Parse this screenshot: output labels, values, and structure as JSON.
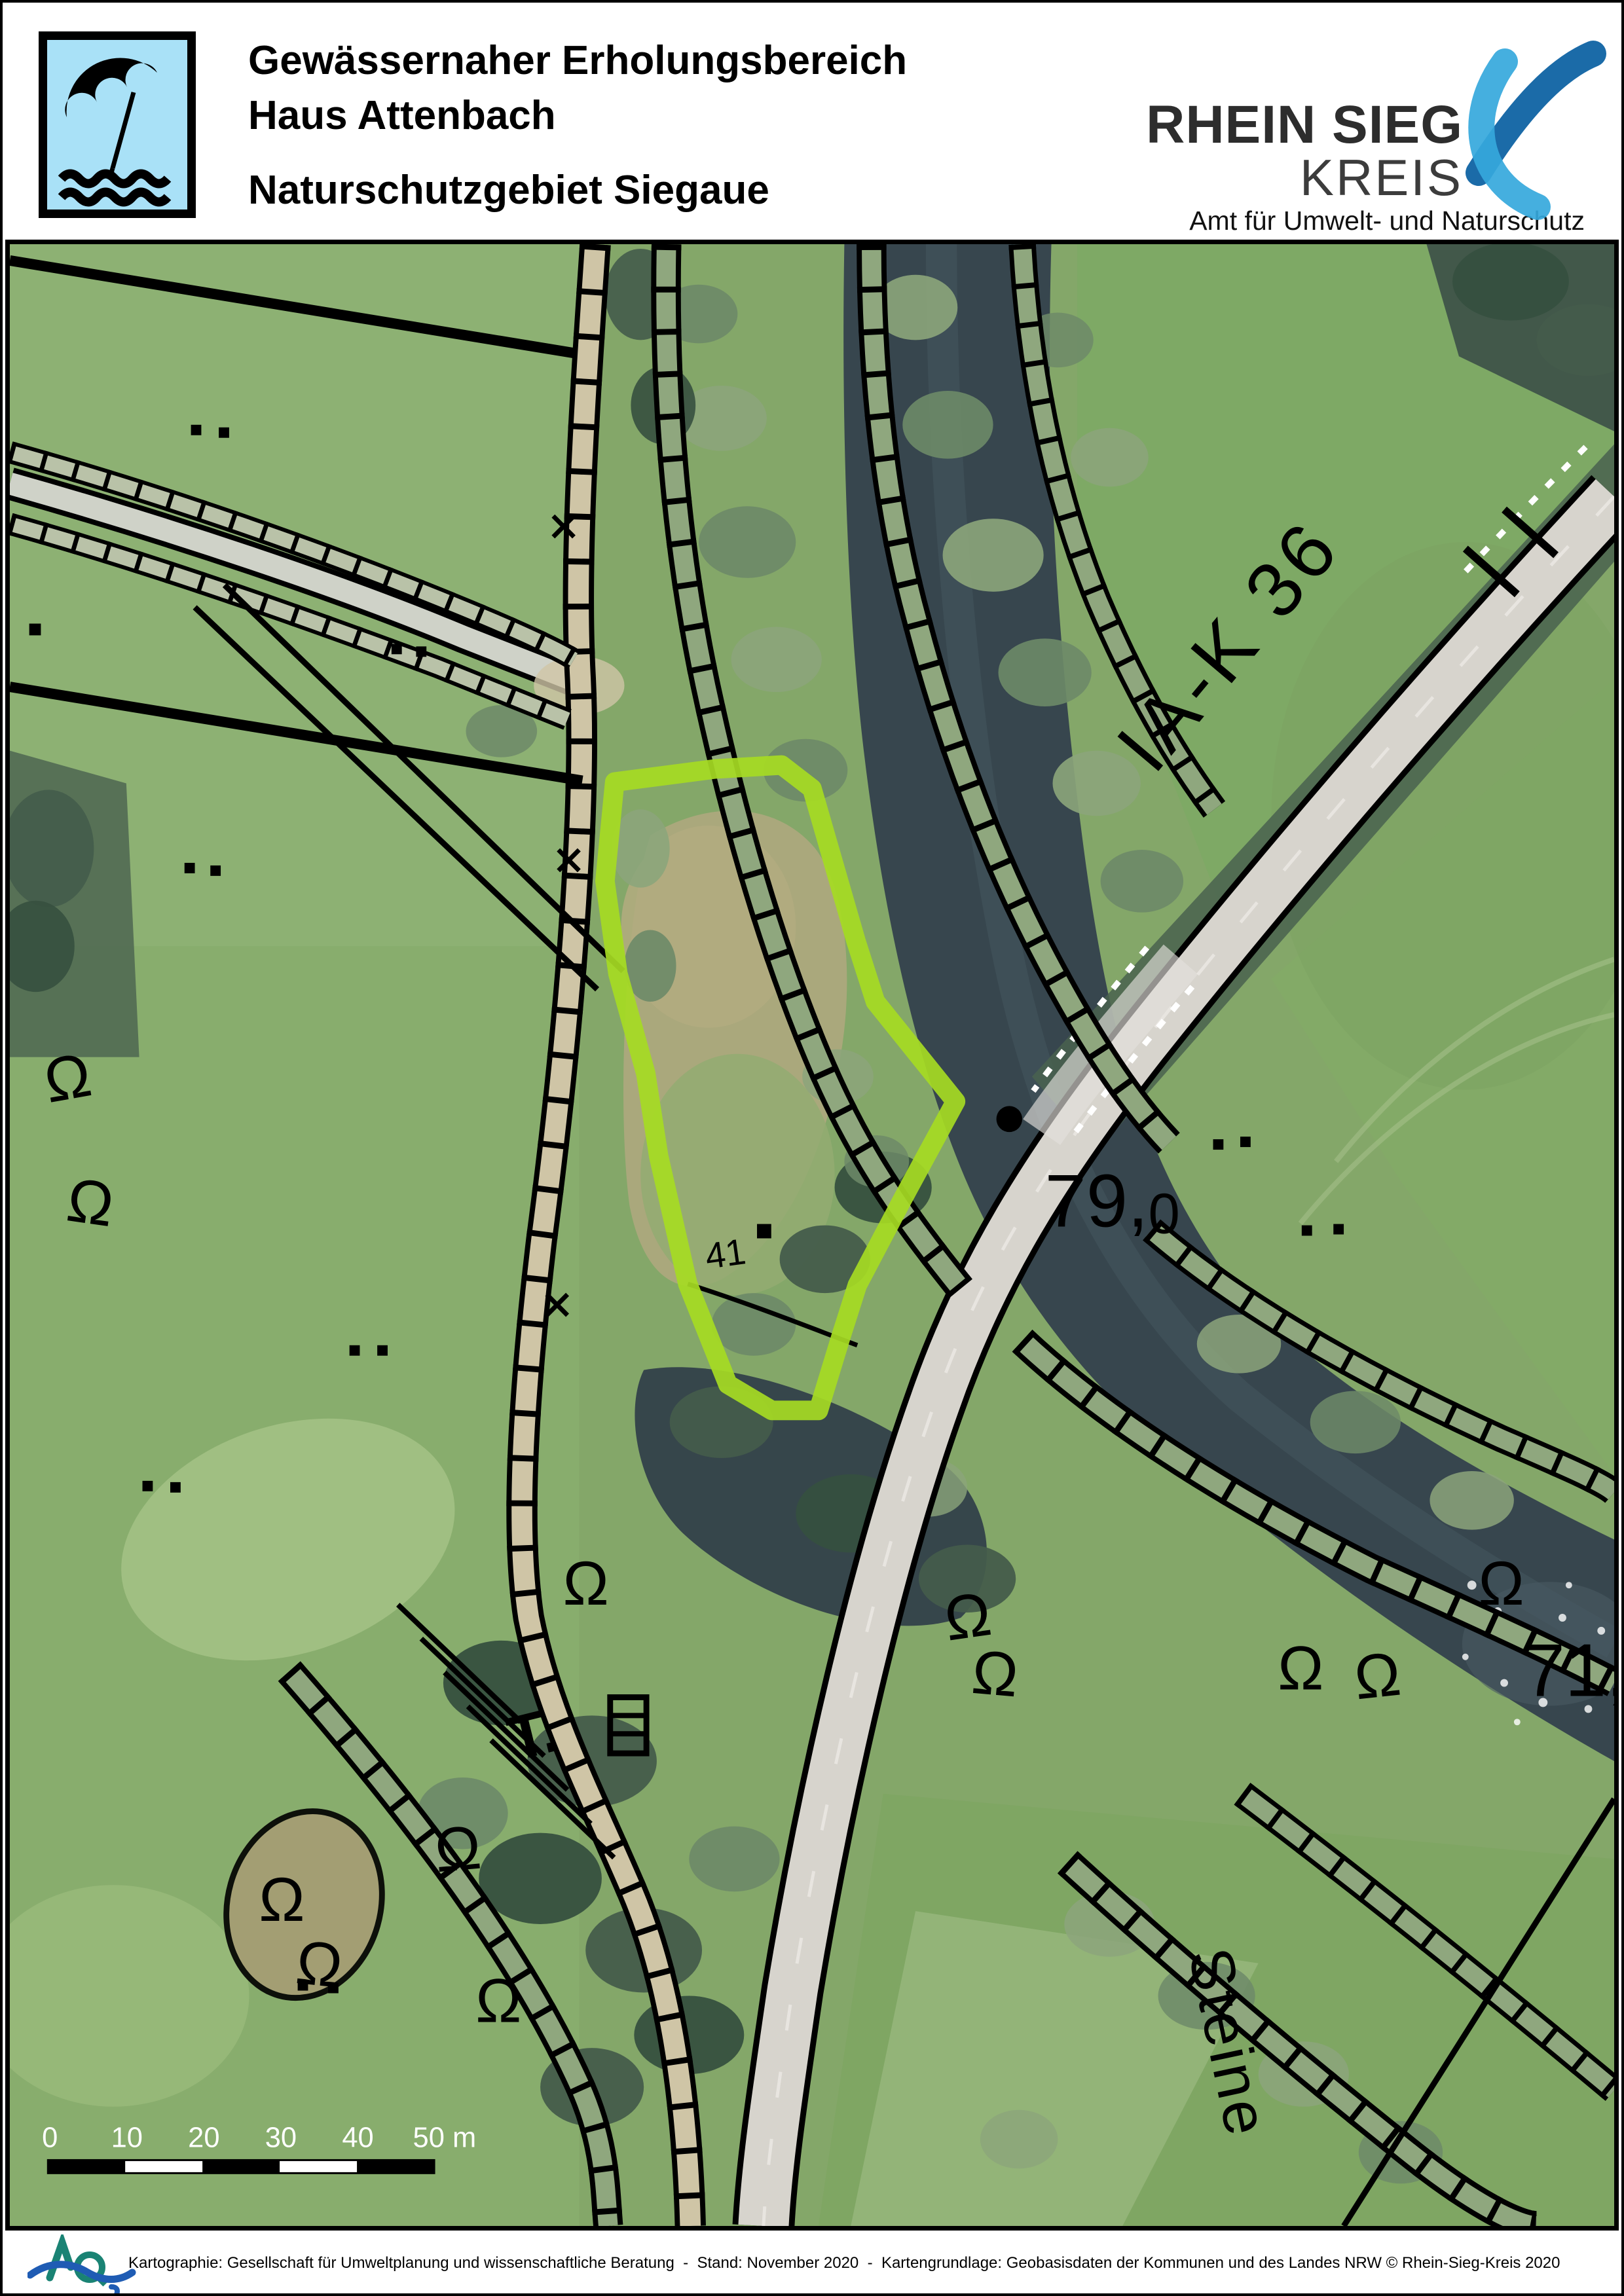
{
  "header": {
    "title_line1": "Gewässernaher Erholungsbereich",
    "title_line2": "Haus Attenbach",
    "title_line3": "Naturschutzgebiet Siegaue",
    "org": {
      "name_top": "RHEIN SIEG",
      "name_bottom": "KREIS",
      "department": "Amt für Umwelt- und Naturschutz"
    }
  },
  "map": {
    "labels": {
      "road": "IA-K 36",
      "elevation_main": "79,",
      "elevation_sub": "0",
      "elevation_right": "71,",
      "street": "Steine",
      "parcel": "41"
    },
    "symbols": {
      "tree": "Ω"
    },
    "scale_bar": {
      "ticks": [
        "0",
        "10",
        "20",
        "30",
        "40"
      ],
      "end_label": "50 m"
    },
    "highlight_color": "#a6db23"
  },
  "footer": {
    "credit": "Kartographie: Gesellschaft für Umweltplanung und wissenschaftliche Beratung  -  Stand: November 2020  -  Kartengrundlage: Geobasisdaten der Kommunen und des Landes NRW © Rhein-Sieg-Kreis 2020"
  },
  "colors": {
    "highlight": "#a6db23",
    "header_icon_bg": "#a9e1f7",
    "logo_light_blue": "#35a8dc",
    "logo_dark_blue": "#1b6ba8",
    "footer_teal": "#1a8374",
    "footer_blue": "#1f5cb4"
  }
}
